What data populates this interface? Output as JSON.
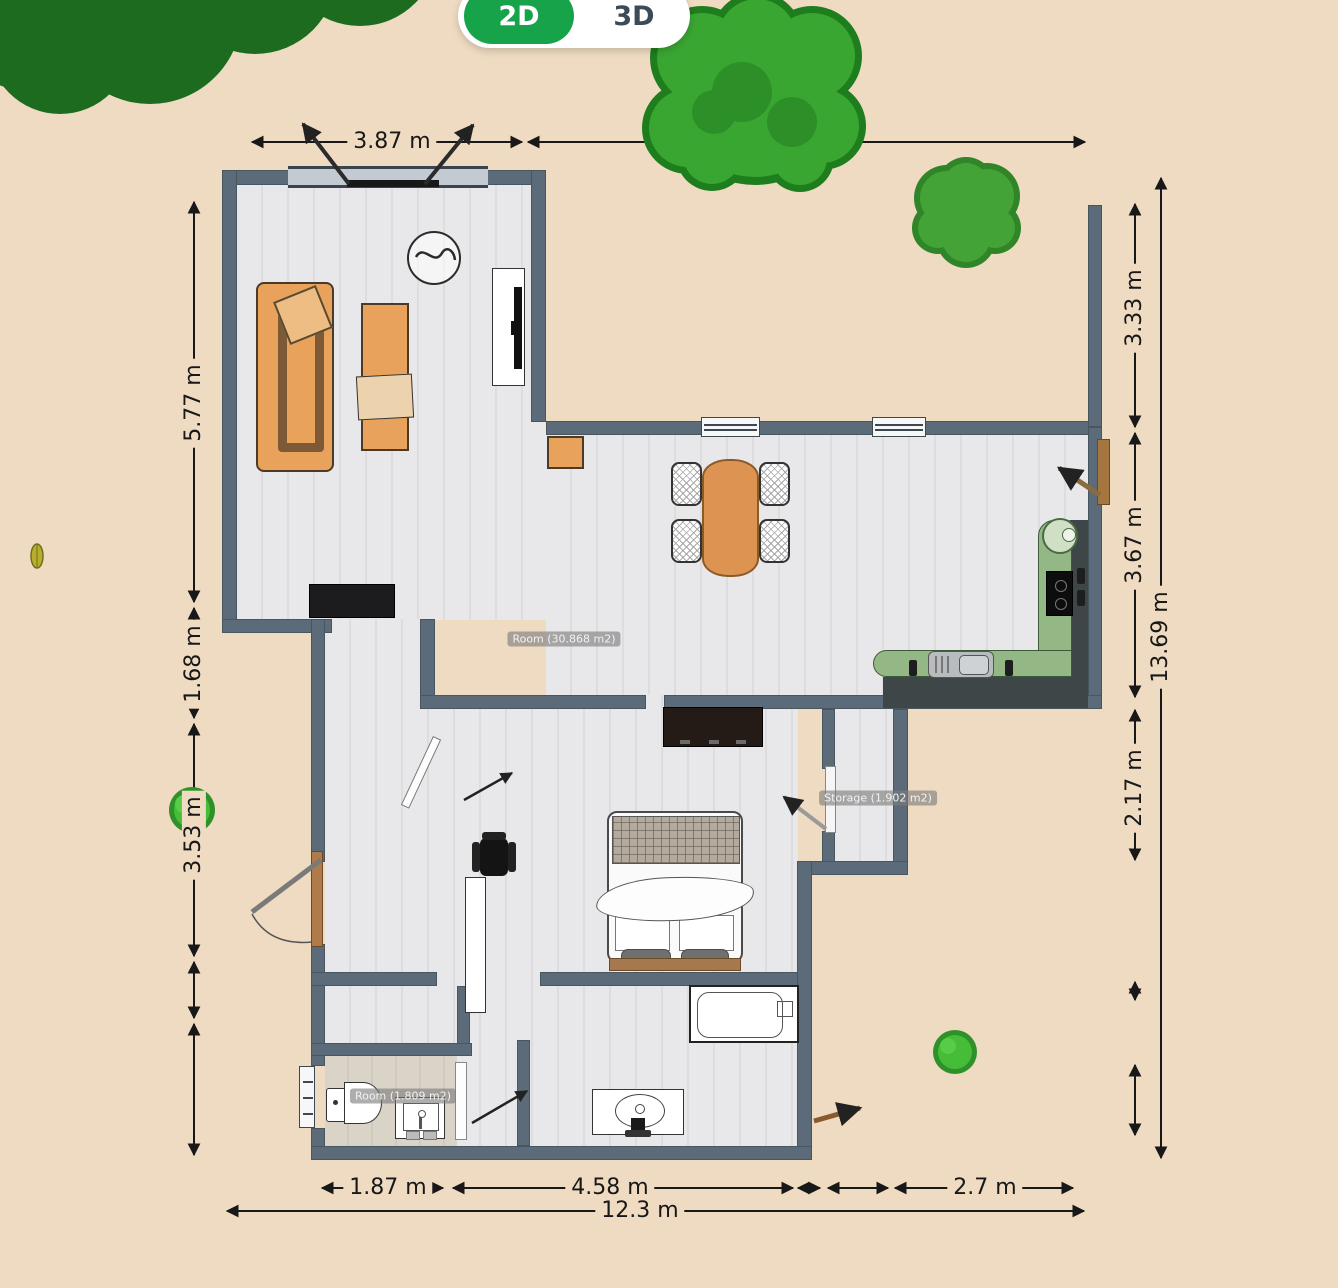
{
  "app": {
    "view_toggle": {
      "active": "2D",
      "inactive": "3D",
      "active_color": "#17a34a"
    }
  },
  "plan": {
    "room_labels": {
      "main": "Room (30.868 m2)",
      "storage": "Storage (1.902 m2)",
      "wc": "Room (1.809 m2)"
    },
    "dimensions": {
      "top": "3.87 m",
      "left_upper": "5.77 m",
      "left_mid": "1.68 m",
      "left_lower": "3.53 m",
      "right_upper": "3.33 m",
      "right_mid": "3.67 m",
      "right_lower": "2.17 m",
      "right_total": "13.69 m",
      "bottom_left": "1.87 m",
      "bottom_mid": "4.58 m",
      "bottom_right": "2.7 m",
      "bottom_total": "12.3 m"
    },
    "colors": {
      "background": "#efdbc2",
      "wall": "#5b6b7a",
      "floor": "#e6e6e8",
      "counter_green": "#94b885",
      "furniture_orange": "#e9a25b",
      "tree_dark": "#1d6b1f",
      "tree_light": "#3aa632"
    }
  }
}
